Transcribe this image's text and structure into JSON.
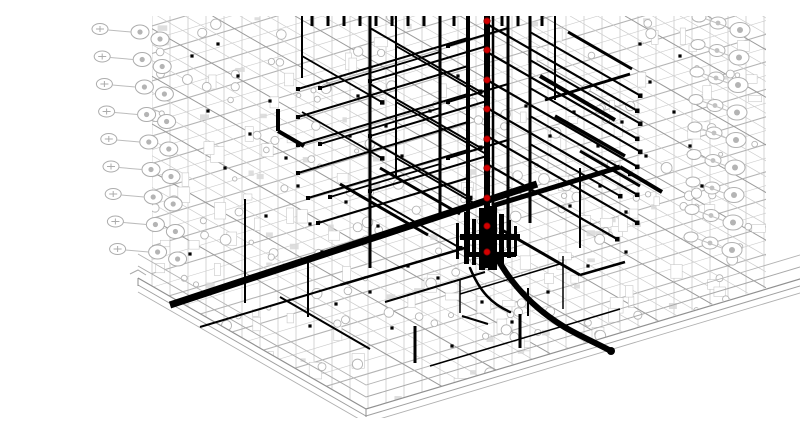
{
  "view": {
    "type": "3d-isometric-cad-view",
    "description": "BIM / Revit-style 3D isometric view of a high-rise tower with black MEP riser piping, red valve markers on the central riser, gray structural wireframe floors with plumbing fixture symbols, and a podium base slab",
    "width": 800,
    "height": 402
  },
  "colors": {
    "background": "#ffffff",
    "wireframe": "#b4b4b4",
    "wireframe_light": "#cccccc",
    "wireframe_dark": "#9a9a9a",
    "pipe": "#000000",
    "valve": "#d40000",
    "valve_outline": "#7a0000",
    "slab_edge": "#909090"
  },
  "building": {
    "mass_polygon": [
      [
        112,
        0
      ],
      [
        726,
        0
      ],
      [
        726,
        272
      ],
      [
        326,
        393
      ],
      [
        98,
        262
      ],
      [
        112,
        240
      ]
    ],
    "floor_spacing": 27.5,
    "column_spacing": 18,
    "shallow_slope": -0.3,
    "steep_slope": 0.577
  },
  "slab": {
    "corner_left": [
      98,
      262
    ],
    "corner_front": [
      326,
      393
    ],
    "edge_right_end": [
      800,
      251
    ],
    "offsets": [
      0,
      7,
      14
    ],
    "curbs": [
      -12,
      -24
    ]
  },
  "fixtures": {
    "left": {
      "start_x": 100,
      "start_y": 16,
      "drift_x": 2.2,
      "spacing": 27.5,
      "count": 9
    },
    "right": {
      "start_x": 700,
      "start_y": 14,
      "drift_x": -1.0,
      "spacing": 27.5,
      "count": 9
    }
  },
  "risers": [
    [
      330,
      0,
      252,
      3
    ],
    [
      356,
      0,
      162,
      2
    ],
    [
      400,
      0,
      198,
      3
    ],
    [
      428,
      0,
      238,
      4
    ],
    [
      447,
      0,
      252,
      6
    ],
    [
      453,
      0,
      250,
      2.5
    ],
    [
      468,
      0,
      232,
      3
    ],
    [
      490,
      0,
      207,
      3
    ],
    [
      515,
      0,
      84,
      2
    ],
    [
      262,
      0,
      62,
      2
    ],
    [
      205,
      183,
      287,
      2
    ],
    [
      268,
      247,
      301,
      2
    ],
    [
      375,
      310,
      347,
      3
    ],
    [
      480,
      298,
      332,
      3
    ],
    [
      540,
      152,
      232,
      2
    ]
  ],
  "branches": {
    "steep": [
      [
        447,
        8,
        150,
        2.2
      ],
      [
        447,
        36,
        150,
        2.2
      ],
      [
        447,
        64,
        150,
        2.2
      ],
      [
        447,
        92,
        150,
        2.2
      ],
      [
        447,
        120,
        150,
        2.2
      ],
      [
        447,
        148,
        130,
        2.2
      ],
      [
        490,
        16,
        110,
        2
      ],
      [
        490,
        44,
        110,
        2
      ],
      [
        490,
        72,
        110,
        2
      ],
      [
        490,
        100,
        100,
        2
      ],
      [
        490,
        128,
        90,
        2
      ],
      [
        330,
        12,
        110,
        2
      ],
      [
        330,
        68,
        110,
        2
      ],
      [
        330,
        124,
        100,
        2
      ],
      [
        330,
        180,
        90,
        2
      ],
      [
        356,
        30,
        90,
        1.8
      ],
      [
        356,
        86,
        90,
        1.8
      ],
      [
        356,
        142,
        80,
        1.8
      ],
      [
        262,
        40,
        80,
        1.8
      ],
      [
        262,
        96,
        80,
        1.8
      ]
    ],
    "shallow": [
      [
        428,
        22,
        170,
        2
      ],
      [
        428,
        50,
        170,
        2
      ],
      [
        428,
        78,
        170,
        2
      ],
      [
        428,
        106,
        170,
        2
      ],
      [
        428,
        134,
        160,
        2
      ],
      [
        428,
        162,
        150,
        2
      ],
      [
        400,
        36,
        120,
        1.8
      ],
      [
        400,
        92,
        120,
        1.8
      ],
      [
        400,
        148,
        110,
        1.8
      ],
      [
        468,
        12,
        60,
        2
      ],
      [
        468,
        68,
        60,
        2
      ],
      [
        468,
        124,
        60,
        2
      ],
      [
        468,
        180,
        60,
        2
      ],
      [
        447,
        30,
        117,
        2
      ],
      [
        447,
        85,
        117,
        2
      ],
      [
        447,
        140,
        117,
        2
      ]
    ]
  },
  "mains": [
    [
      497,
      168,
      130,
      289,
      7
    ],
    [
      452,
      190,
      580,
      151,
      5
    ],
    [
      580,
      151,
      622,
      176,
      4
    ],
    [
      238,
      93,
      238,
      115,
      4
    ],
    [
      238,
      115,
      264,
      130,
      4
    ],
    [
      500,
      60,
      575,
      104,
      4
    ],
    [
      515,
      100,
      585,
      140,
      3.5
    ],
    [
      528,
      16,
      592,
      53,
      3
    ],
    [
      540,
      135,
      600,
      170,
      3
    ],
    [
      505,
      84,
      590,
      58,
      3
    ],
    [
      300,
      168,
      388,
      219,
      3
    ],
    [
      340,
      152,
      420,
      198,
      3
    ],
    [
      160,
      311,
      300,
      269,
      2
    ],
    [
      300,
      269,
      428,
      231,
      2.5
    ],
    [
      240,
      281,
      330,
      333,
      2
    ],
    [
      345,
      286,
      445,
      256,
      2
    ],
    [
      462,
      214,
      540,
      259,
      3
    ],
    [
      540,
      259,
      585,
      246,
      2.5
    ],
    [
      420,
      263,
      420,
      297,
      1.5
    ],
    [
      523,
      240,
      523,
      293,
      1.5
    ],
    [
      420,
      278,
      523,
      247,
      1.5
    ],
    [
      390,
      350,
      580,
      293,
      1.5
    ],
    [
      488,
      272,
      488,
      300,
      2
    ],
    [
      422,
      300,
      448,
      308,
      2
    ]
  ],
  "roof_stubs": {
    "xs": [
      272,
      288,
      304,
      320,
      336,
      352,
      368,
      384,
      414,
      462,
      478,
      502
    ],
    "height": 10,
    "width": 3
  },
  "hub_bars": [
    [
      424,
      196,
      5,
      52
    ],
    [
      432,
      203,
      4,
      46
    ],
    [
      439,
      192,
      6,
      62
    ],
    [
      448,
      190,
      9,
      64
    ],
    [
      459,
      198,
      5,
      50
    ],
    [
      467,
      204,
      4,
      38
    ],
    [
      416,
      207,
      3,
      36
    ],
    [
      474,
      210,
      3,
      30
    ],
    [
      420,
      218,
      60,
      6
    ],
    [
      424,
      236,
      52,
      5
    ]
  ],
  "flex_pipe": {
    "d": "M 452 232 C 468 266 494 293 526 312 C 544 322 562 330 569 334",
    "width": 6,
    "cap": [
      571,
      335,
      4
    ],
    "d2": "M 430 252 C 440 276 452 288 470 296",
    "width2": 2.5
  },
  "valves": {
    "x": 447,
    "r": 3.2,
    "ys": [
      5,
      34,
      64,
      93,
      123,
      152,
      182,
      210,
      236
    ]
  },
  "dots": [
    [
      152,
      40
    ],
    [
      178,
      28
    ],
    [
      198,
      60
    ],
    [
      168,
      95
    ],
    [
      210,
      118
    ],
    [
      185,
      152
    ],
    [
      230,
      85
    ],
    [
      246,
      142
    ],
    [
      258,
      170
    ],
    [
      226,
      200
    ],
    [
      270,
      208
    ],
    [
      150,
      238
    ],
    [
      282,
      236
    ],
    [
      310,
      120
    ],
    [
      318,
      80
    ],
    [
      346,
      110
    ],
    [
      362,
      140
    ],
    [
      306,
      186
    ],
    [
      338,
      210
    ],
    [
      390,
      95
    ],
    [
      418,
      60
    ],
    [
      486,
      90
    ],
    [
      510,
      120
    ],
    [
      534,
      96
    ],
    [
      558,
      130
    ],
    [
      582,
      106
    ],
    [
      606,
      140
    ],
    [
      560,
      170
    ],
    [
      586,
      196
    ],
    [
      530,
      190
    ],
    [
      610,
      66
    ],
    [
      634,
      96
    ],
    [
      650,
      130
    ],
    [
      600,
      28
    ],
    [
      640,
      40
    ],
    [
      662,
      170
    ],
    [
      368,
      250
    ],
    [
      330,
      276
    ],
    [
      398,
      262
    ],
    [
      442,
      286
    ],
    [
      508,
      276
    ],
    [
      472,
      306
    ],
    [
      548,
      250
    ],
    [
      586,
      236
    ],
    [
      352,
      312
    ],
    [
      412,
      330
    ],
    [
      270,
      310
    ],
    [
      296,
      288
    ]
  ]
}
